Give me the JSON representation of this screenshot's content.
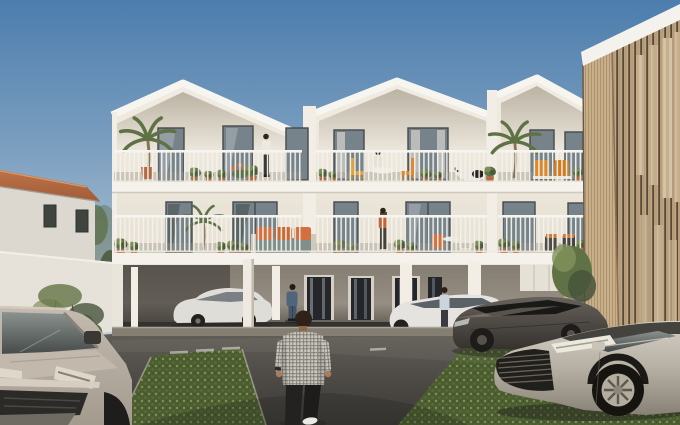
{
  "scene": {
    "type": "exterior architectural rendering",
    "main_building": {
      "name": "white apartment building",
      "floors": 3,
      "gabled_bays": 3,
      "ground_level": "open carport on white pilotis",
      "balconies": "full-width white railings with potted plants and outdoor furniture"
    },
    "left_building": {
      "name": "neighboring house",
      "roof": "terracotta tiles",
      "front": "white boundary wall with shrubs and small trees"
    },
    "right_building": {
      "name": "timber-slat clad building",
      "facade": "vertical wood slats with recessed glazing"
    },
    "vehicles": [
      {
        "name": "grey compact van",
        "position": "bottom-left foreground"
      },
      {
        "name": "white sedan",
        "position": "parked under building, left"
      },
      {
        "name": "white sedan",
        "position": "parked under building, right"
      },
      {
        "name": "dark grey sedan",
        "position": "parked on grass pavers, right"
      },
      {
        "name": "silver sedan",
        "position": "bottom-right foreground"
      }
    ],
    "people": [
      {
        "name": "man in plaid shirt walking away",
        "position": "center foreground"
      },
      {
        "name": "man in blue jacket",
        "position": "under building near entrance"
      },
      {
        "name": "woman beside white sedan",
        "position": "right carport"
      },
      {
        "name": "woman standing",
        "position": "top-floor balcony left"
      },
      {
        "name": "woman seated at table",
        "position": "top-floor balcony middle"
      },
      {
        "name": "dog lying down",
        "position": "top-floor balcony middle"
      },
      {
        "name": "woman standing",
        "position": "first-floor balcony middle"
      }
    ],
    "ground": {
      "surface": "asphalt drive with green permeable grass pavers",
      "markings": "white parking stall lines"
    }
  },
  "colors": {
    "sky_top": "#4c7dad",
    "sky_mid": "#7c9fc0",
    "sky_low": "#b3c6d3",
    "sky_horizon": "#d9dcd6",
    "facade_light": "#f1ece3",
    "facade_dark": "#e3dccd",
    "gable_shadow": "#b7af9f",
    "fascia": "#f7f5f0",
    "slab": "#f5f2ec",
    "pier": "#f2eee6",
    "railing": "#f3f1ea",
    "railing_shadow": "#8d867b",
    "window_frame": "#46494b",
    "glass_mid": "#76838b",
    "glass_dark": "#535b60",
    "curtain": "#c8c6c2",
    "house_wall": "#dcd7cf",
    "roof_terracotta": "#bd7347",
    "roof_terracotta_dark": "#a25c38",
    "boundary_wall": "#e6e2d9",
    "foliage_dark": "#47543a",
    "foliage_mid": "#5f7245",
    "foliage_light": "#82925a",
    "timber_coping": "#f4f2ec",
    "timber_light": "#d8c09b",
    "timber_mid": "#c8ab82",
    "timber_dark": "#8a6c4c",
    "timber_window": "#3f382f",
    "timber_glint": "#ddd2bd",
    "recess_top": "#847d72",
    "recess_bottom": "#4a4640",
    "back_wall": "#968e83",
    "door_glass": "#24262a",
    "door_panel": "#d6d0c4",
    "curb": "#857e73",
    "asphalt_light": "#605c56",
    "asphalt_dark": "#3b3936",
    "paver_base": "#4c5e31",
    "paver_dot": "#7e9150",
    "marking": "#e8e6df",
    "car_white": "#e4e3df",
    "car_dark_top": "#66615a",
    "car_dark_bottom": "#332f2b",
    "car_silver_top": "#d6d0c6",
    "car_silver_bottom": "#878176",
    "van_top": "#c3bab0",
    "van_bottom": "#a49b8f",
    "grille_dark": "#2b2a27",
    "chrome": "#d5cec1",
    "wheel": "#1d1c1a",
    "hub": "#8e8880",
    "skin": "#a97c5f",
    "hair": "#2e2219",
    "plaid_base": "#cbc8c0",
    "plaid_line": "#8f8c83",
    "pants_black": "#232221",
    "denim": "#50657b",
    "jeans": "#475469",
    "top_white": "#ece9e3",
    "top_orange": "#c06538",
    "top_lightblue": "#ccd5dc",
    "pot": "#b06a44",
    "cushion_orange": "#d4703f",
    "chair_yellow": "#e2a23a",
    "chair_orange": "#d98a2e",
    "sofa_base": "#7e8f8c",
    "dog_white": "#e9e6e0",
    "dog_black": "#26231f",
    "shadow": "#1f1e1c"
  }
}
